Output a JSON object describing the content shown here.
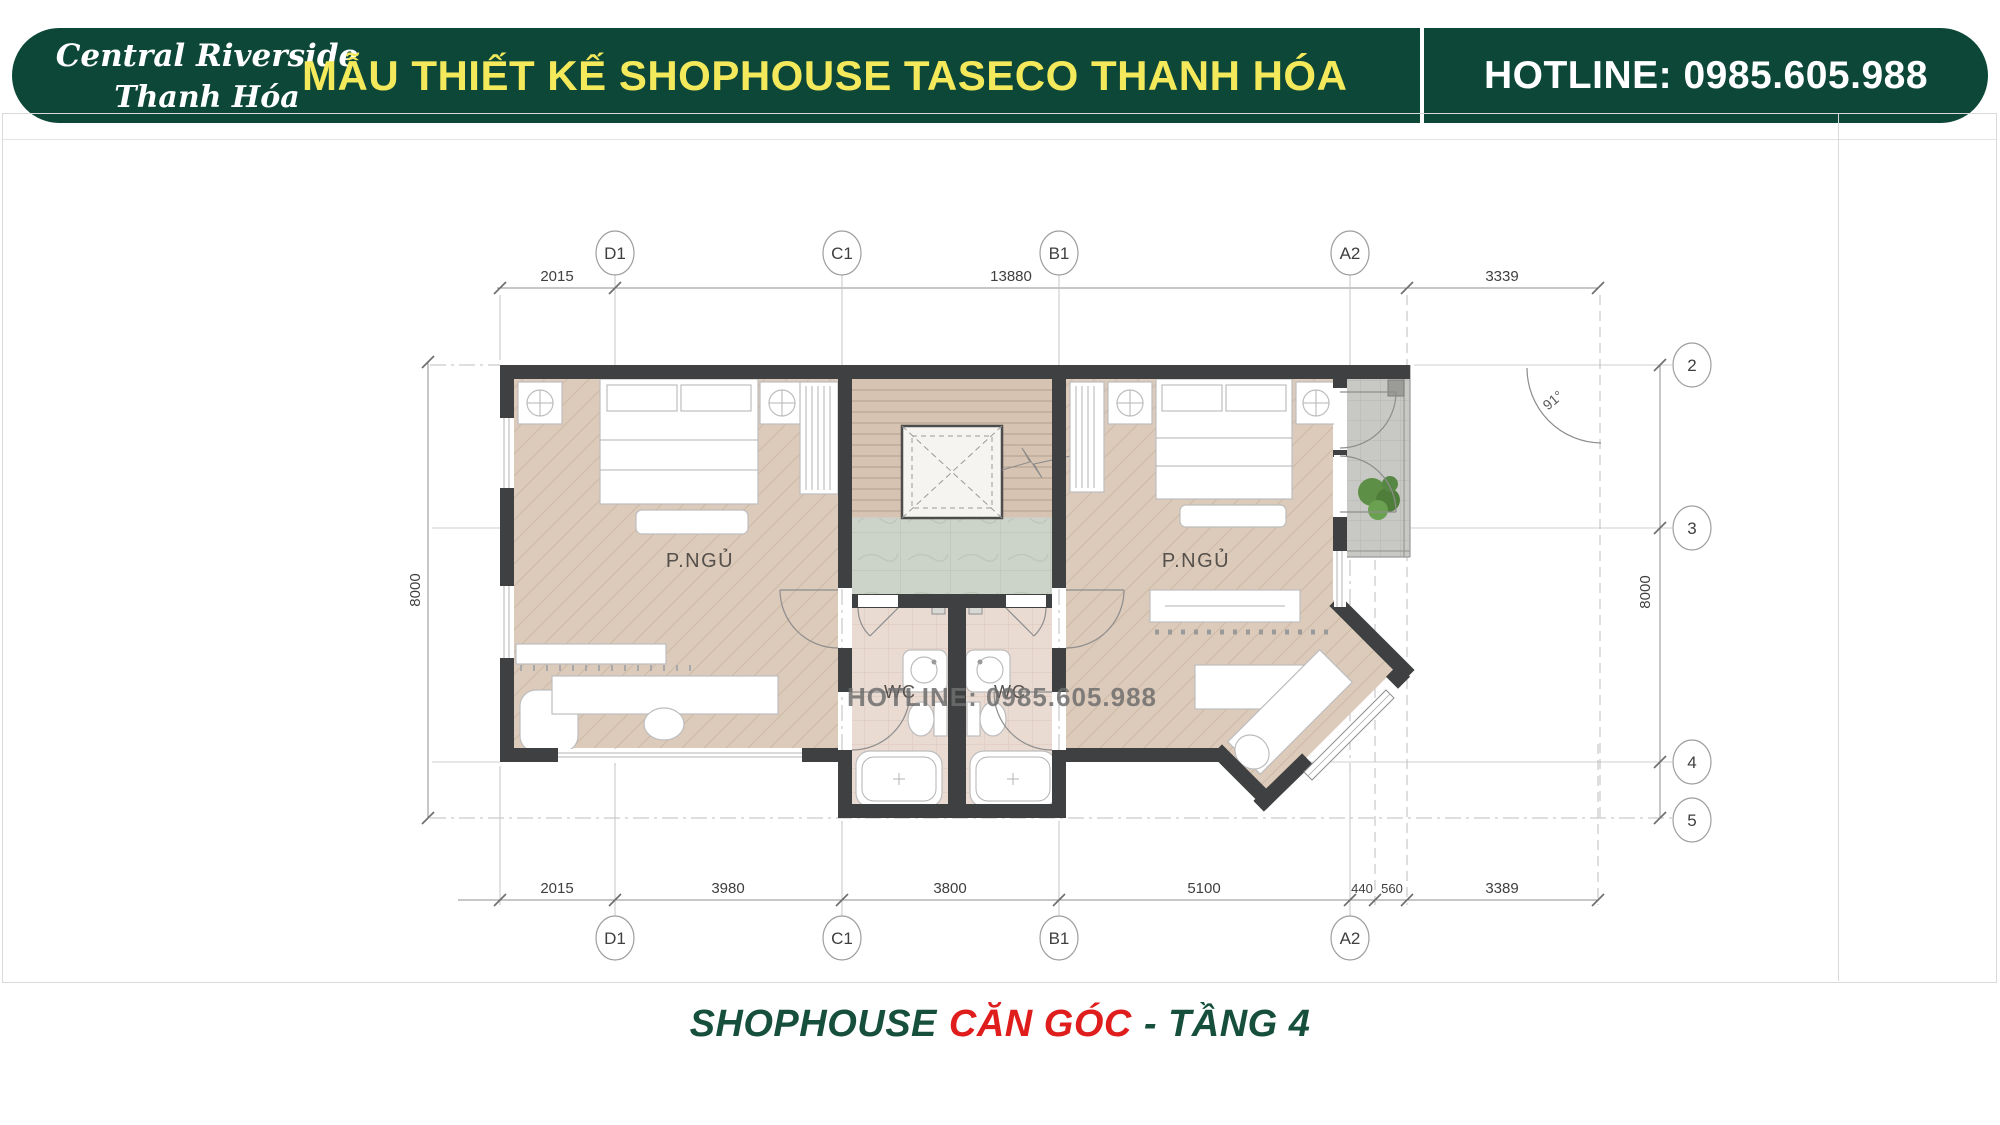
{
  "header": {
    "logo": {
      "line1": "Central Riverside",
      "line2": "Thanh Hóa"
    },
    "title": "MẪU THIẾT KẾ SHOPHOUSE TASECO THANH HÓA",
    "hotline": "HOTLINE: 0985.605.988"
  },
  "watermark": "HOTLINE: 0985.605.988",
  "footer": {
    "part1": "SHOPHOUSE",
    "part2": "CĂN GÓC",
    "part3": "- TẦNG 4"
  },
  "plan": {
    "rooms": {
      "bedroom_left": "P.NGỦ",
      "bedroom_right": "P.NGỦ",
      "wc_left": "WC",
      "wc_right": "WC"
    },
    "angle_label": "91°",
    "grid": {
      "top": [
        "D1",
        "C1",
        "B1",
        "A2"
      ],
      "bottom": [
        "D1",
        "C1",
        "B1",
        "A2"
      ],
      "right": [
        "2",
        "3",
        "4",
        "5"
      ]
    },
    "dims": {
      "top": [
        "2015",
        "13880",
        "3339"
      ],
      "bottom": [
        "2015",
        "3980",
        "3800",
        "5100",
        "440",
        "560",
        "3389"
      ],
      "left": [
        "8000"
      ],
      "right": [
        "8000"
      ]
    }
  },
  "colors": {
    "header_green": "#0c4737",
    "title_yellow": "#f3e95b",
    "hotline_text": "#ffffff",
    "footer_green": "#16503c",
    "footer_red": "#df1d1d",
    "wall": "#3e4041",
    "watermark": "#6e6e6e"
  }
}
